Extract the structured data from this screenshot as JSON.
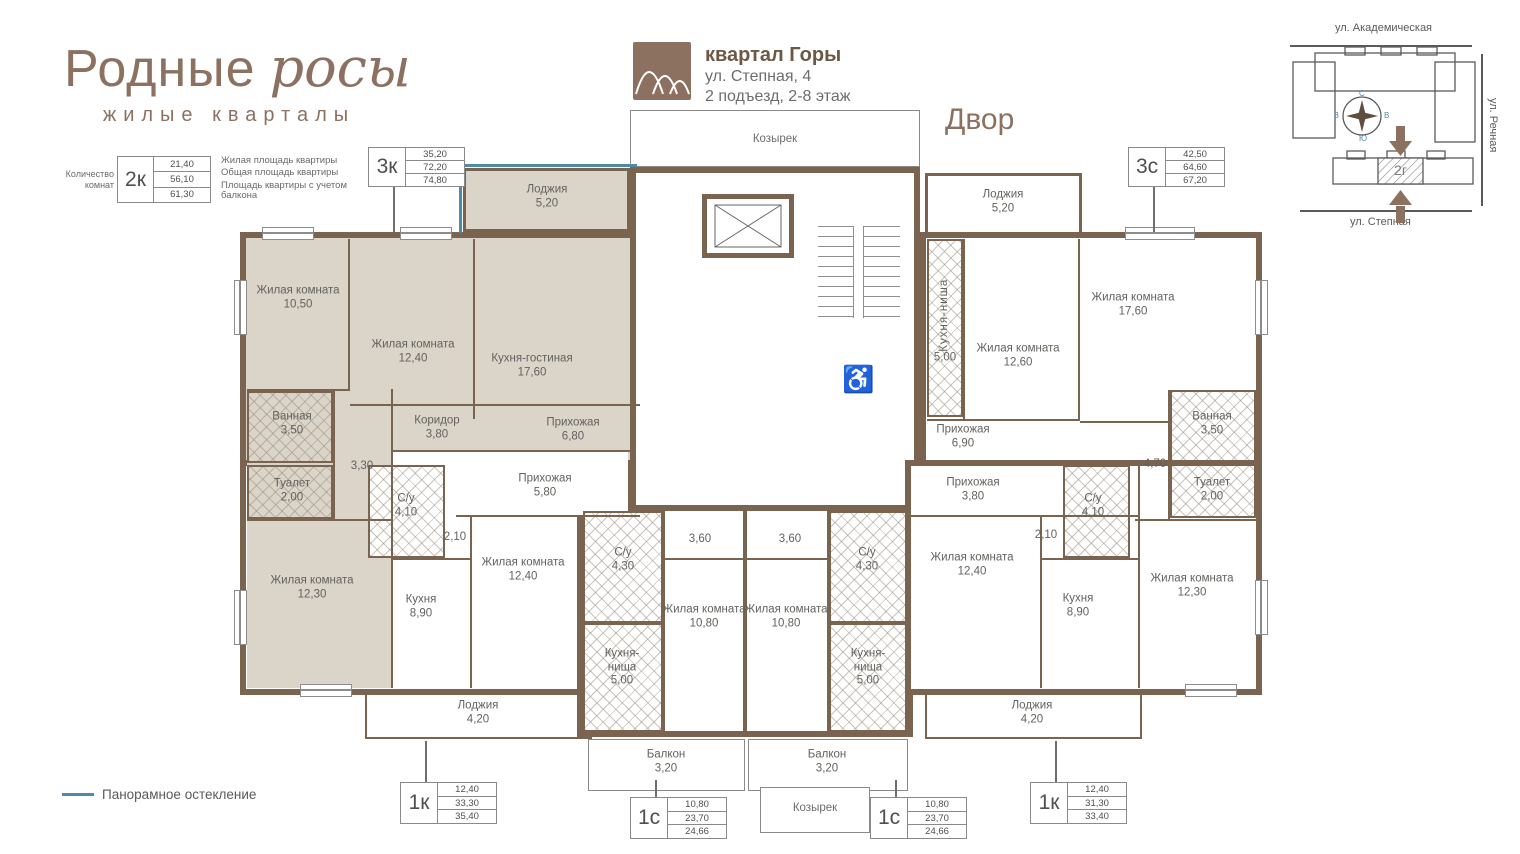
{
  "logo": {
    "title_regular": "Родные",
    "title_script": "росы",
    "subtitle": "жилые кварталы"
  },
  "legend_key": {
    "rooms_count_label": "Количество комнат",
    "sample_type": "2к",
    "values": [
      "21,40",
      "56,10",
      "61,30"
    ],
    "value_labels": [
      "Жилая площадь квартиры",
      "Общая площадь квартиры",
      "Площадь квартиры с учетом балкона"
    ]
  },
  "header": {
    "quarter": "квартал Горы",
    "address": "ул. Степная, 4",
    "entrance_floors": "2 подъезд, 2-8 этаж",
    "yard_label": "Двор"
  },
  "minimap": {
    "street_top": "ул. Академическая",
    "street_right": "ул. Речная",
    "street_bottom": "ул. Степная",
    "building_label": "2г",
    "compass": {
      "n": "С",
      "e": "В",
      "s": "Ю",
      "w": "З"
    }
  },
  "glazing_legend": "Панорамное остекление",
  "tags": [
    {
      "type": "3к",
      "values": [
        "35,20",
        "72,20",
        "74,80"
      ]
    },
    {
      "type": "3с",
      "values": [
        "42,50",
        "64,60",
        "67,20"
      ]
    },
    {
      "type": "1к",
      "values": [
        "12,40",
        "33,30",
        "35,40"
      ]
    },
    {
      "type": "1с",
      "values": [
        "10,80",
        "23,70",
        "24,66"
      ]
    },
    {
      "type": "1с",
      "values": [
        "10,80",
        "23,70",
        "24,66"
      ]
    },
    {
      "type": "1к",
      "values": [
        "12,40",
        "31,30",
        "33,40"
      ]
    }
  ],
  "rooms": {
    "k3_living1": {
      "name": "Жилая комната",
      "area": "10,50"
    },
    "k3_living2": {
      "name": "Жилая комната",
      "area": "12,40"
    },
    "k3_kitchen_living": {
      "name": "Кухня-гостиная",
      "area": "17,60"
    },
    "k3_corridor": {
      "name": "Коридор",
      "area": "3,80"
    },
    "k3_hall": {
      "name": "Прихожая",
      "area": "6,80"
    },
    "k3_bathroom": {
      "name": "Ванная",
      "area": "3,50"
    },
    "k3_toilet": {
      "name": "Туалет",
      "area": "2,00"
    },
    "k3_hall2": {
      "area": "3,30"
    },
    "k3_living3": {
      "name": "Жилая комната",
      "area": "12,30"
    },
    "k3_loggia": {
      "name": "Лоджия",
      "area": "5,20"
    },
    "k1L_hall": {
      "name": "Прихожая",
      "area": "5,80"
    },
    "k1L_wc": {
      "name": "С/у",
      "area": "4,10"
    },
    "k1L_hall2": {
      "area": "2,10"
    },
    "k1L_kitchen": {
      "name": "Кухня",
      "area": "8,90"
    },
    "k1L_living": {
      "name": "Жилая комната",
      "area": "12,40"
    },
    "k1L_loggia": {
      "name": "Лоджия",
      "area": "4,20"
    },
    "s1L_hall": {
      "area": "3,60"
    },
    "s1L_wc": {
      "name": "С/у",
      "area": "4,30"
    },
    "s1L_living": {
      "name": "Жилая комната",
      "area": "10,80"
    },
    "s1L_kitchen": {
      "name": "Кухня-ниша",
      "area": "5,00"
    },
    "s1L_balcony": {
      "name": "Балкон",
      "area": "3,20"
    },
    "s1R_hall": {
      "area": "3,60"
    },
    "s1R_wc": {
      "name": "С/у",
      "area": "4,30"
    },
    "s1R_living": {
      "name": "Жилая комната",
      "area": "10,80"
    },
    "s1R_kitchen": {
      "name": "Кухня-ниша",
      "area": "5,00"
    },
    "s1R_balcony": {
      "name": "Балкон",
      "area": "3,20"
    },
    "k1R_hall": {
      "name": "Прихожая",
      "area": "3,80"
    },
    "k1R_hall2": {
      "area": "2,10"
    },
    "k1R_wc": {
      "name": "С/у",
      "area": "4,10"
    },
    "k1R_kitchen": {
      "name": "Кухня",
      "area": "8,90"
    },
    "k1R_living": {
      "name": "Жилая комната",
      "area": "12,40"
    },
    "k1R_loggia": {
      "name": "Лоджия",
      "area": "4,20"
    },
    "s3_kitchen_niche": {
      "name": "Кухня-ниша",
      "area": "5,00"
    },
    "s3_living1": {
      "name": "Жилая комната",
      "area": "12,60"
    },
    "s3_living2": {
      "name": "Жилая комната",
      "area": "17,60"
    },
    "s3_hall": {
      "name": "Прихожая",
      "area": "6,90"
    },
    "s3_bathroom": {
      "name": "Ванная",
      "area": "3,50"
    },
    "s3_toilet": {
      "name": "Туалет",
      "area": "2,00"
    },
    "s3_hall2": {
      "area": "4,70"
    },
    "s3_living3": {
      "name": "Жилая комната",
      "area": "12,30"
    },
    "s3_loggia": {
      "name": "Лоджия",
      "area": "5,20"
    },
    "canopy_top": {
      "name": "Козырек"
    },
    "canopy_bottom": {
      "name": "Козырек"
    }
  },
  "colors": {
    "brand_brown": "#8c7160",
    "wall_brown": "#7a6450",
    "highlight_beige": "#dbd4c9",
    "glazing_blue": "#4d8ba6"
  }
}
